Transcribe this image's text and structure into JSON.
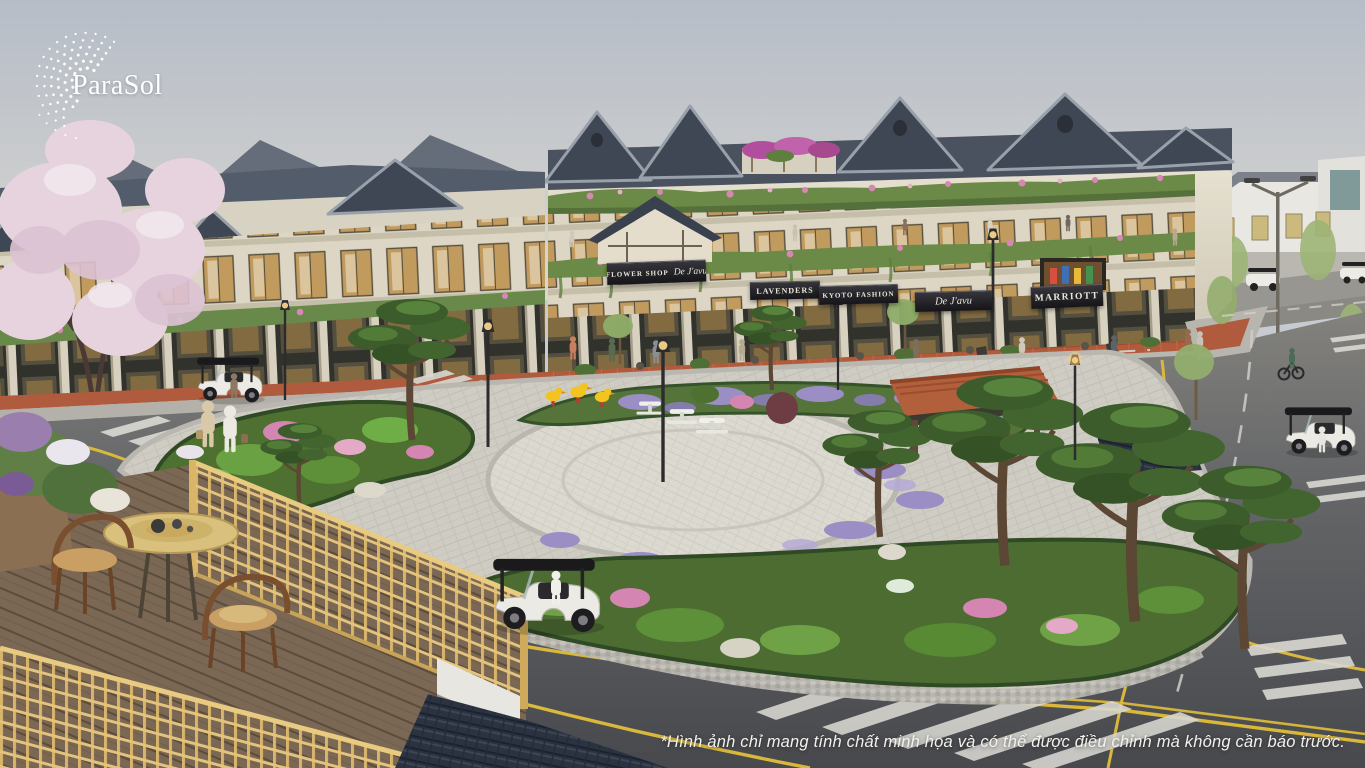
{
  "logo": {
    "text": "ParaSol"
  },
  "signs": {
    "flower_shop_label": "FLOWER SHOP",
    "flower_shop_brand": "De J'avu",
    "lavenders": "LAVENDERS",
    "kyoto_fashion": "KYOTO FASHION",
    "de_javu": "De J'avu",
    "marriott": "MARRIOTT"
  },
  "footer": {
    "disclaimer": "*Hình ảnh chỉ mang tính chất minh họa và có thể được điều chỉnh mà không cần báo trước."
  },
  "palette": {
    "sky_top": "#b9c0c9",
    "sky_horizon": "#d8d5cc",
    "roof_slate": "#3f4754",
    "roof_ridge": "#98a0aa",
    "wall_cream": "#e2dccc",
    "window_wood": "#c19a5e",
    "balcony_green": "#6b8a47",
    "blossom_pink": "#e7d3de",
    "flower_pink": "#d687b3",
    "lavender_purple": "#9a8ec4",
    "road_asphalt": "#54555a",
    "lane_yellow": "#d9b83c",
    "paving_light": "#cfccc3",
    "sidewalk_terracotta": "#b2593c",
    "fence_bamboo_yellow": "#d9b569",
    "pavilion_terracotta": "#b2603c",
    "pine_green": "#3c5c2b",
    "cart_body_white": "#eceae4"
  }
}
